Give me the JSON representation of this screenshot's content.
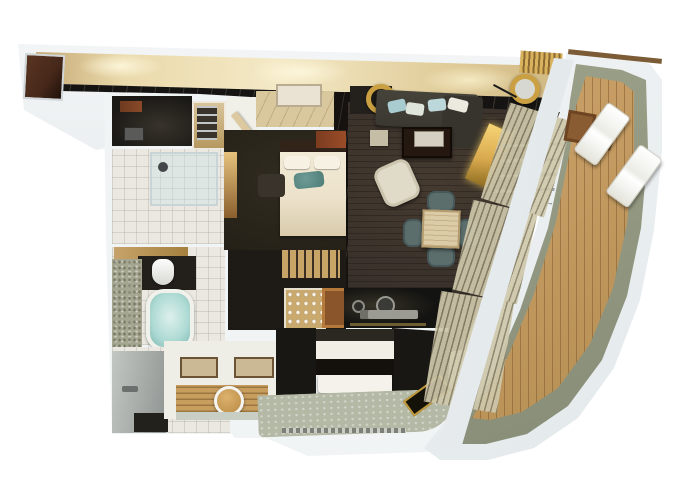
{
  "scene": {
    "title": "3D rendered top-down floor plan of a luxury ship suite with curved teak veranda",
    "areas": [
      {
        "name": "corridor"
      },
      {
        "name": "entry-foyer"
      },
      {
        "name": "entry-vestibule"
      },
      {
        "name": "steam-shower-room"
      },
      {
        "name": "hanger-closet"
      },
      {
        "name": "shower-room"
      },
      {
        "name": "bathtub-room"
      },
      {
        "name": "vanity-area"
      },
      {
        "name": "dressing-area"
      },
      {
        "name": "master-bedroom"
      },
      {
        "name": "pantry-bar-closet"
      },
      {
        "name": "living-room"
      },
      {
        "name": "dining-area"
      },
      {
        "name": "wet-bar"
      },
      {
        "name": "second-bedroom"
      },
      {
        "name": "spa-floor"
      },
      {
        "name": "balcony-deck"
      }
    ],
    "furniture": [
      "corridor-door",
      "entry-door-leaf",
      "hangers",
      "glass-shower",
      "shower-head",
      "toilet",
      "wood-shelf",
      "bathtub",
      "vanity-counter",
      "bath-mat",
      "dressing-table",
      "round-gold-mirror",
      "console-table",
      "master-bed",
      "pillows",
      "teal-throw",
      "headboard",
      "rust-panel",
      "ottoman",
      "lit-closet",
      "shelf-unit",
      "bar-glassware",
      "wood-box",
      "sofa",
      "sofa-pillows",
      "coffee-table",
      "serving-tray",
      "cube-side-table",
      "armchair",
      "arc-floor-lamp",
      "media-console",
      "rail-console",
      "dining-table",
      "dining-chair",
      "louver-screen",
      "bar-sink",
      "bar-faucet",
      "control-panel",
      "second-bed",
      "foot-bench",
      "deck-bench",
      "sun-lounger",
      "deck-side-table",
      "deck-chair"
    ]
  },
  "palette": {
    "page-bg": "#ffffff",
    "slab": "#f1f4f5",
    "hull": "#f7f9fa",
    "deck-rim": "#848a74",
    "wood": "#c59c63",
    "wood-line": "#8a6333",
    "marble-black": "#161412",
    "foyer-marble": "#d9c89e",
    "carpet": "#242017",
    "living-floor": "#38302a",
    "bath-floor": "#eae8e0",
    "mosaic": "#a5a690",
    "tub-aqua": "#aedad4",
    "tub-aqua-light": "#ddf0ec",
    "louver": "#cfc8ab",
    "bed-cream": "#ece2cb",
    "pillow-white": "#f6f1e3",
    "teal": "#4d7d78",
    "bed2-white": "#f1eee6",
    "bed2-black": "#14110c",
    "sofa": "#3b3831",
    "pillow-aqua": "#a8ccd0",
    "chair-teal": "#5b6e6c",
    "travertine": "#dbcba6",
    "gold": "#d9a94e",
    "gold-deep": "#8a6a1e",
    "rust": "#7c3c20",
    "door-brown": "#46281a",
    "counter-gray": "#a9aeab",
    "spa-floor": "#b4b9a6",
    "glow-amber": "#e6c27c",
    "console-cream": "#eae3d3",
    "wet-bar": "#131311"
  }
}
